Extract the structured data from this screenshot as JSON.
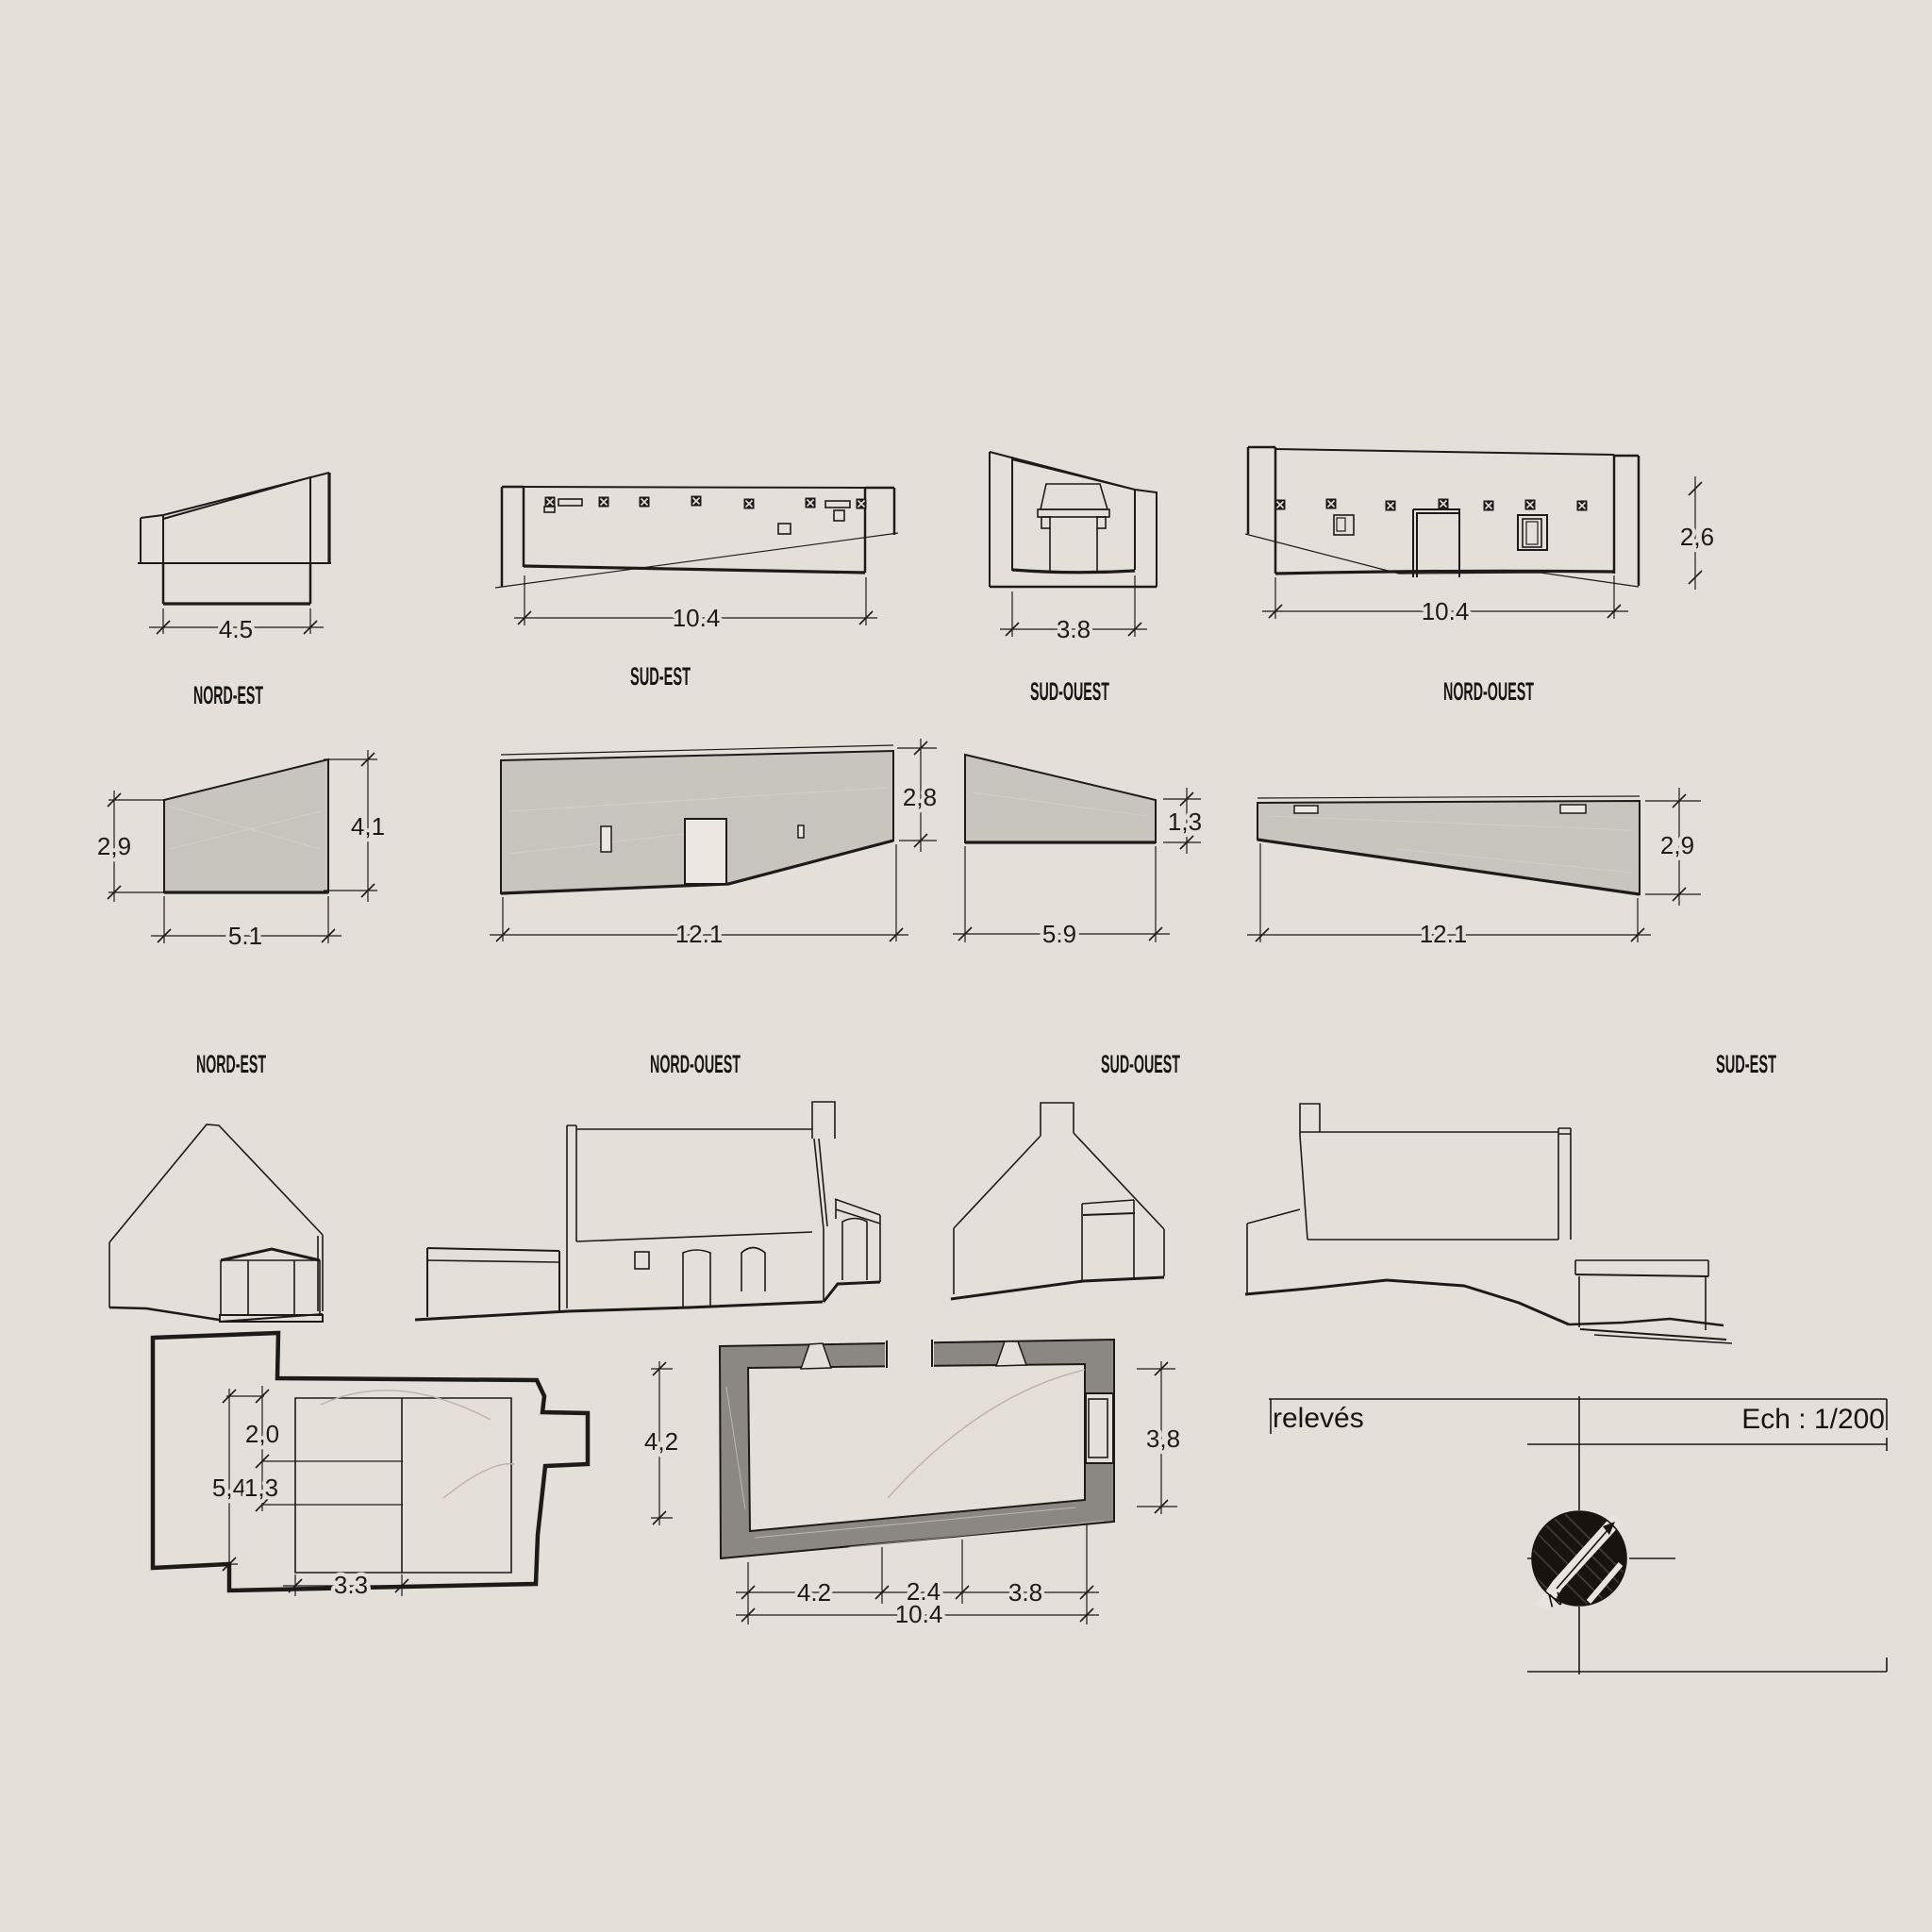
{
  "colors": {
    "background": "#e5dfd9",
    "line": "#1c1b19",
    "section_fill": "#c8c4be",
    "wall_fill": "#8b8782",
    "compass_fill": "#17130f"
  },
  "top_row": [
    {
      "label": "NORD-EST",
      "dim_w": "4.5"
    },
    {
      "label": "SUD-EST",
      "dim_w": "10.4"
    },
    {
      "label": "SUD-OUEST",
      "dim_w": "3.8"
    },
    {
      "label": "NORD-OUEST",
      "dim_w": "10.4",
      "dim_h": "2,6"
    }
  ],
  "mid_row": [
    {
      "label": "NORD-EST",
      "dim_left": "2,9",
      "dim_right": "4,1",
      "dim_w": "5.1"
    },
    {
      "label": "NORD-OUEST",
      "dim_right": "2,8",
      "dim_w": "12.1"
    },
    {
      "label": "SUD-OUEST",
      "dim_right": "1,3",
      "dim_w": "5.9"
    },
    {
      "label": "SUD-EST",
      "dim_right": "2,9",
      "dim_w": "12.1"
    }
  ],
  "floor_plan": {
    "dim_a": "2,0",
    "dim_b": "5,4",
    "dim_c": "1,3",
    "dim_w": "3.3"
  },
  "masonry_plan": {
    "dim_left": "4,2",
    "dim_right": "3,8",
    "dim_b1": "4.2",
    "dim_b2": "2.4",
    "dim_b3": "3.8",
    "dim_total": "10.4"
  },
  "title_block": {
    "title": "relevés",
    "scale": "Ech : 1/200",
    "north": "N"
  }
}
